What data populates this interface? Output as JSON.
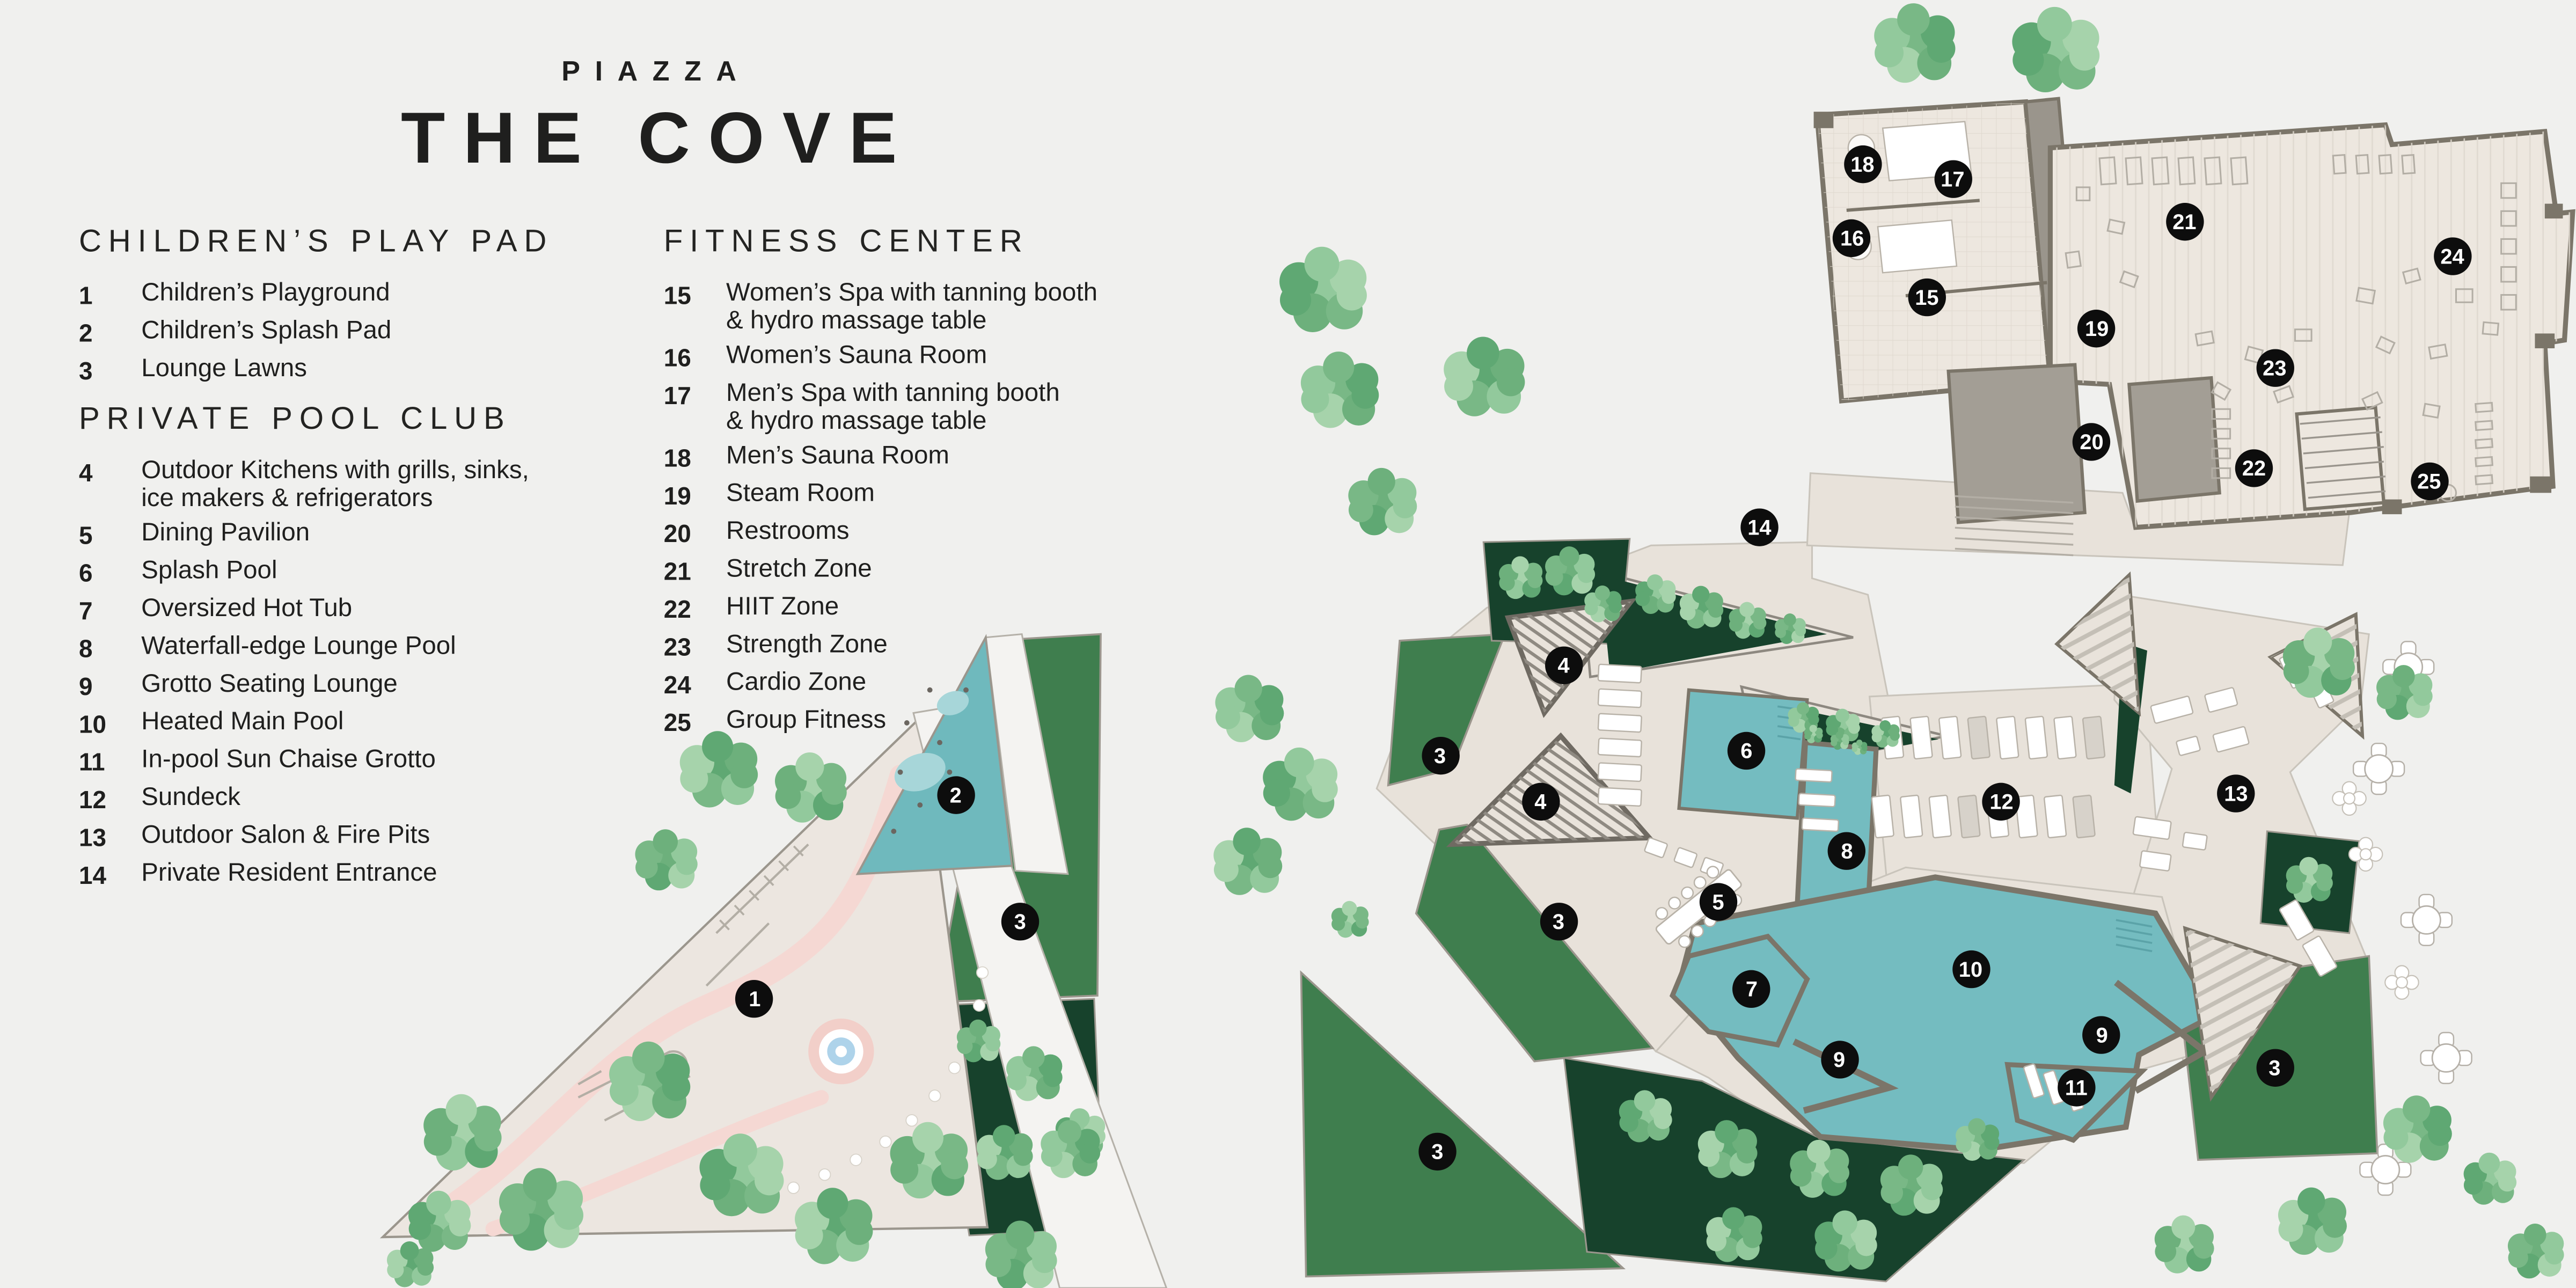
{
  "title": {
    "eyebrow": "PIAZZA",
    "name": "THE COVE"
  },
  "legend": {
    "sections": [
      {
        "heading": "CHILDREN’S PLAY PAD",
        "items": [
          {
            "num": "1",
            "label": "Children’s Playground"
          },
          {
            "num": "2",
            "label": "Children’s Splash Pad"
          },
          {
            "num": "3",
            "label": "Lounge Lawns"
          }
        ]
      },
      {
        "heading": "PRIVATE POOL CLUB",
        "items": [
          {
            "num": "4",
            "label": "Outdoor Kitchens with grills, sinks,\nice makers & refrigerators"
          },
          {
            "num": "5",
            "label": "Dining Pavilion"
          },
          {
            "num": "6",
            "label": "Splash Pool"
          },
          {
            "num": "7",
            "label": "Oversized Hot Tub"
          },
          {
            "num": "8",
            "label": "Waterfall-edge Lounge Pool"
          },
          {
            "num": "9",
            "label": "Grotto Seating Lounge"
          },
          {
            "num": "10",
            "label": "Heated Main Pool"
          },
          {
            "num": "11",
            "label": "In-pool Sun Chaise Grotto"
          },
          {
            "num": "12",
            "label": "Sundeck"
          },
          {
            "num": "13",
            "label": "Outdoor Salon & Fire Pits"
          },
          {
            "num": "14",
            "label": "Private Resident Entrance"
          }
        ]
      },
      {
        "heading": "FITNESS CENTER",
        "items": [
          {
            "num": "15",
            "label": "Women’s Spa with tanning booth\n& hydro massage table"
          },
          {
            "num": "16",
            "label": "Women’s Sauna Room"
          },
          {
            "num": "17",
            "label": "Men’s Spa with tanning booth\n& hydro massage table"
          },
          {
            "num": "18",
            "label": "Men’s Sauna Room"
          },
          {
            "num": "19",
            "label": "Steam Room"
          },
          {
            "num": "20",
            "label": "Restrooms"
          },
          {
            "num": "21",
            "label": "Stretch Zone"
          },
          {
            "num": "22",
            "label": "HIIT Zone"
          },
          {
            "num": "23",
            "label": "Strength Zone"
          },
          {
            "num": "24",
            "label": "Cardio Zone"
          },
          {
            "num": "25",
            "label": "Group Fitness"
          }
        ]
      }
    ]
  },
  "map": {
    "colors": {
      "background": "#f0f0ee",
      "deck": "#e8e2da",
      "playground": "#ece6e0",
      "lawn": "#3f7e4e",
      "lawn_dark": "#17422c",
      "pool": "#74bcc0",
      "splash_pad": "#6fb9bd",
      "walls": "#7b7569",
      "marker": "#0d0d0d",
      "marker_text": "#ffffff"
    },
    "markers": [
      {
        "num": "1",
        "x": 29.3,
        "y": 77.6
      },
      {
        "num": "2",
        "x": 37.1,
        "y": 61.7
      },
      {
        "num": "3",
        "x": 39.6,
        "y": 71.6
      },
      {
        "num": "3",
        "x": 55.9,
        "y": 58.7
      },
      {
        "num": "3",
        "x": 60.5,
        "y": 71.6
      },
      {
        "num": "3",
        "x": 55.8,
        "y": 89.4
      },
      {
        "num": "3",
        "x": 88.3,
        "y": 82.9
      },
      {
        "num": "4",
        "x": 60.7,
        "y": 51.7
      },
      {
        "num": "4",
        "x": 59.8,
        "y": 62.2
      },
      {
        "num": "5",
        "x": 66.7,
        "y": 70.0
      },
      {
        "num": "6",
        "x": 67.8,
        "y": 58.3
      },
      {
        "num": "7",
        "x": 68.0,
        "y": 76.8
      },
      {
        "num": "8",
        "x": 71.7,
        "y": 66.1
      },
      {
        "num": "9",
        "x": 71.4,
        "y": 82.3
      },
      {
        "num": "9",
        "x": 81.6,
        "y": 80.4
      },
      {
        "num": "10",
        "x": 76.5,
        "y": 75.3
      },
      {
        "num": "11",
        "x": 80.6,
        "y": 84.4
      },
      {
        "num": "12",
        "x": 77.7,
        "y": 62.2
      },
      {
        "num": "13",
        "x": 86.8,
        "y": 61.6
      },
      {
        "num": "14",
        "x": 68.3,
        "y": 40.9
      },
      {
        "num": "15",
        "x": 74.8,
        "y": 23.1
      },
      {
        "num": "16",
        "x": 71.9,
        "y": 18.5
      },
      {
        "num": "17",
        "x": 75.8,
        "y": 13.9
      },
      {
        "num": "18",
        "x": 72.3,
        "y": 12.8
      },
      {
        "num": "19",
        "x": 81.4,
        "y": 25.5
      },
      {
        "num": "20",
        "x": 81.2,
        "y": 34.3
      },
      {
        "num": "21",
        "x": 84.8,
        "y": 17.2
      },
      {
        "num": "22",
        "x": 87.5,
        "y": 36.4
      },
      {
        "num": "23",
        "x": 88.3,
        "y": 28.6
      },
      {
        "num": "24",
        "x": 95.2,
        "y": 19.9
      },
      {
        "num": "25",
        "x": 94.3,
        "y": 37.4
      }
    ]
  }
}
